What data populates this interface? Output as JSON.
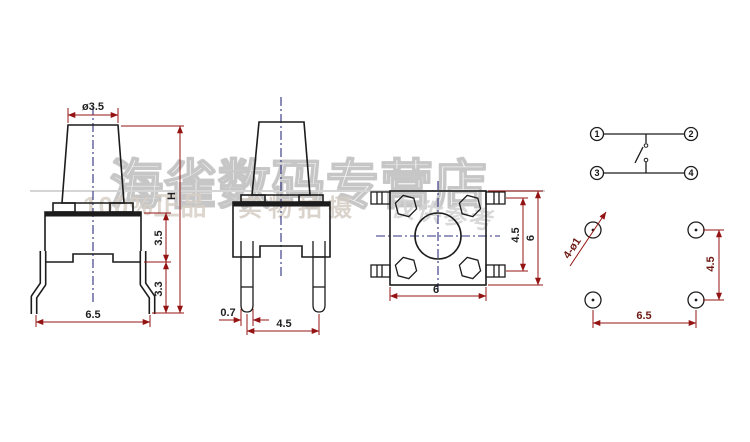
{
  "watermarks": {
    "store": "海雀数码专营店",
    "left": "100%正品",
    "center": "实物拍摄",
    "right": "仅供参考"
  },
  "side_view": {
    "stem_diameter": "ø3.5",
    "total_height": "H",
    "body_height": "3.5",
    "leg_length": "3.3",
    "foot_span": "6.5"
  },
  "front_view": {
    "pin_width": "0.7",
    "pin_pitch": "4.5"
  },
  "top_view": {
    "body_width": "6",
    "pin_row_pitch": "4.5",
    "body_depth": "6"
  },
  "schematic": {
    "pin1": "1",
    "pin2": "2",
    "pin3": "3",
    "pin4": "4"
  },
  "footprint": {
    "hole_spec": "4-ø1",
    "row_pitch": "4.5",
    "hole_span": "6.5"
  },
  "colors": {
    "line": "#1c1c1c",
    "dimension": "#941414",
    "centerline": "#2f2f7f",
    "watermark": "#c6c6c6"
  }
}
